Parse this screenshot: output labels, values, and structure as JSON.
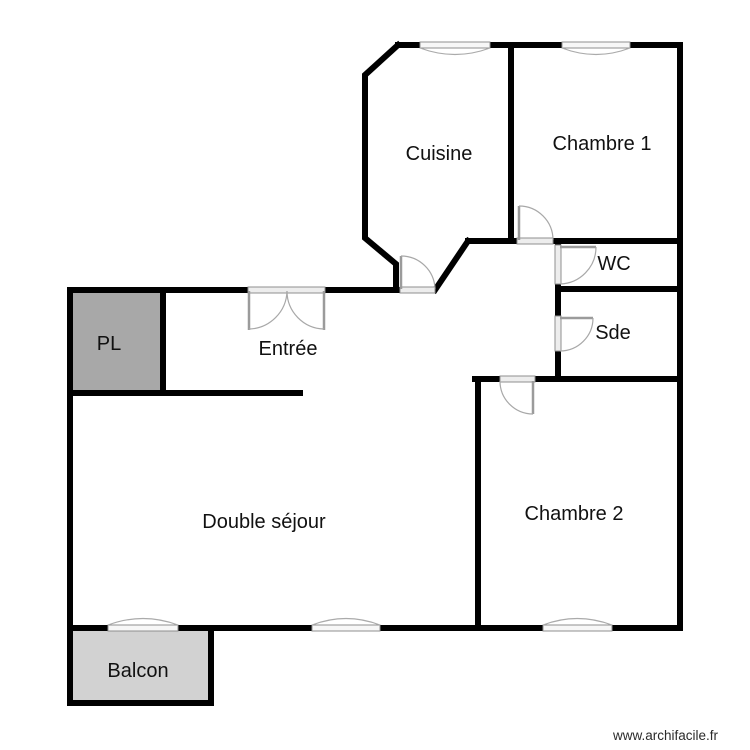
{
  "page": {
    "watermark": "www.archifacile.fr",
    "background": "#ffffff"
  },
  "palette": {
    "wall": "#000000",
    "closet_fill": "#a8a8a8",
    "balcony_fill": "#d2d2d2",
    "symbol_gray": "#a8a8a8",
    "text": "#111111"
  },
  "rooms": {
    "cuisine": {
      "label": "Cuisine"
    },
    "chambre1": {
      "label": "Chambre 1"
    },
    "wc": {
      "label": "WC"
    },
    "sde": {
      "label": "Sde"
    },
    "entree": {
      "label": "Entrée"
    },
    "pl": {
      "label": "PL"
    },
    "double_sejour": {
      "label": "Double séjour"
    },
    "chambre2": {
      "label": "Chambre 2"
    },
    "balcon": {
      "label": "Balcon"
    }
  }
}
